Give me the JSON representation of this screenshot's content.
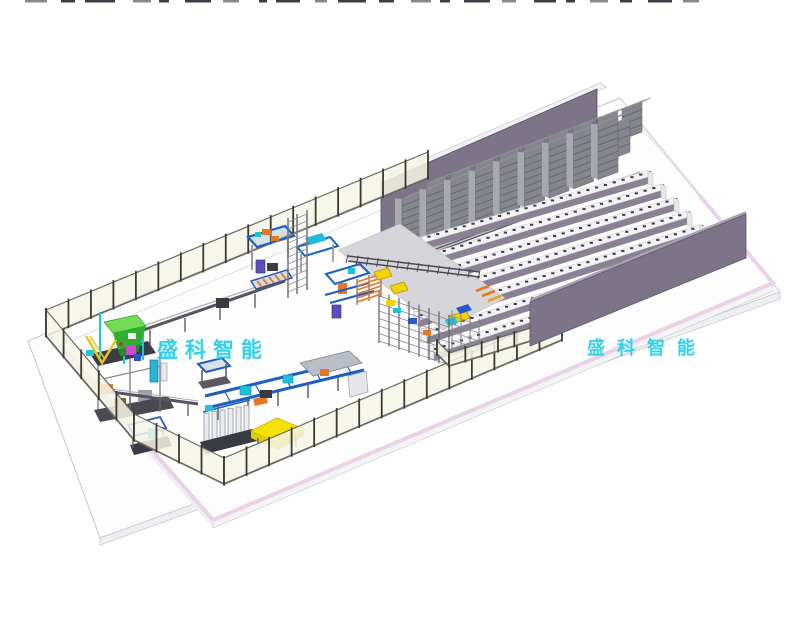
{
  "scene": {
    "kind": "3d-cad-factory-layout-rendering",
    "watermark_left": {
      "text": "盛科智能",
      "color": "#2BCFE8"
    },
    "watermark_right": {
      "text": "盛科智能",
      "color": "#2BCFE8"
    }
  },
  "counts": {
    "rack_columns": 9,
    "rack_rows": 3,
    "conveyor_lanes": 7,
    "fence_segments": 4
  },
  "colors": {
    "background": "#FFFFFF",
    "floor_top": "#FDFDFE",
    "floor_side": "#EFEFF3",
    "floor_edge_pink": "#EAD2E8",
    "floor_line": "#C6C6CC",
    "wall_purple": "#7D7488",
    "wall_top_light": "#A9A1B2",
    "roof_strip": "#F2F2F5",
    "rack_face": "#85858D",
    "rack_stripe": "#62626A",
    "rack_side": "#A8A8B0",
    "rack_cap": "#C7C7CF",
    "rack_cap_edge": "#8E8E96",
    "lane_top": "#F3F3F6",
    "lane_face": "#8A8294",
    "lane_tick": "#3C3C44",
    "aisle_gray": "#C2C2C8",
    "corridor_gray": "#D6D6DA",
    "track_dark": "#4A4A52",
    "fence_panel": "#F6F4E8",
    "fence_post": "#3A3A30",
    "fence_rail": "#6A6A5E",
    "machine_blue": "#1B5FBF",
    "steel_gray": "#9FA3AB",
    "dark_gray": "#3A3A42",
    "cyan_accent": "#1EC0DC",
    "green_hopper": "#2FAE2F",
    "green_hopper_top": "#74DC52",
    "magenta_accent": "#D048D0",
    "yellow_accent": "#F2D200",
    "yellow_pallet": "#F4E200",
    "orange_accent": "#E07828",
    "purple_accent": "#5A4FB5",
    "red_accent": "#D03030"
  }
}
